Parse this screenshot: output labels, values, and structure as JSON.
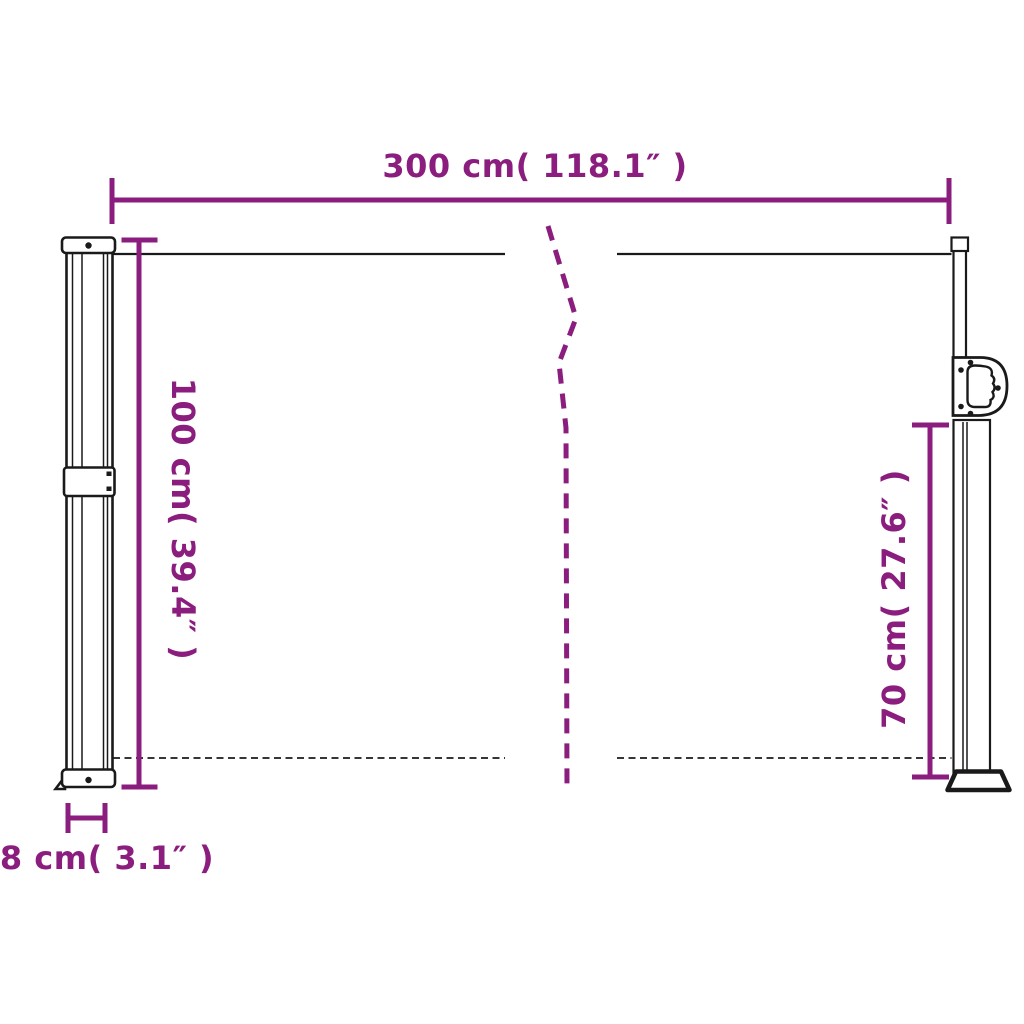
{
  "diagram": {
    "background_color": "#ffffff",
    "accent_color": "#8A1D7D",
    "outline_color": "#1a1a1a",
    "dimensions": {
      "width": {
        "label": "300 cm( 118.1″ )",
        "cm": 300,
        "inches": 118.1
      },
      "height": {
        "label": "100 cm( 39.4″ )",
        "cm": 100,
        "inches": 39.4
      },
      "extension_height": {
        "label": "70 cm( 27.6″ )",
        "cm": 70,
        "inches": 27.6
      },
      "depth": {
        "label": "8 cm( 3.1″ )",
        "cm": 8,
        "inches": 3.1
      }
    }
  }
}
